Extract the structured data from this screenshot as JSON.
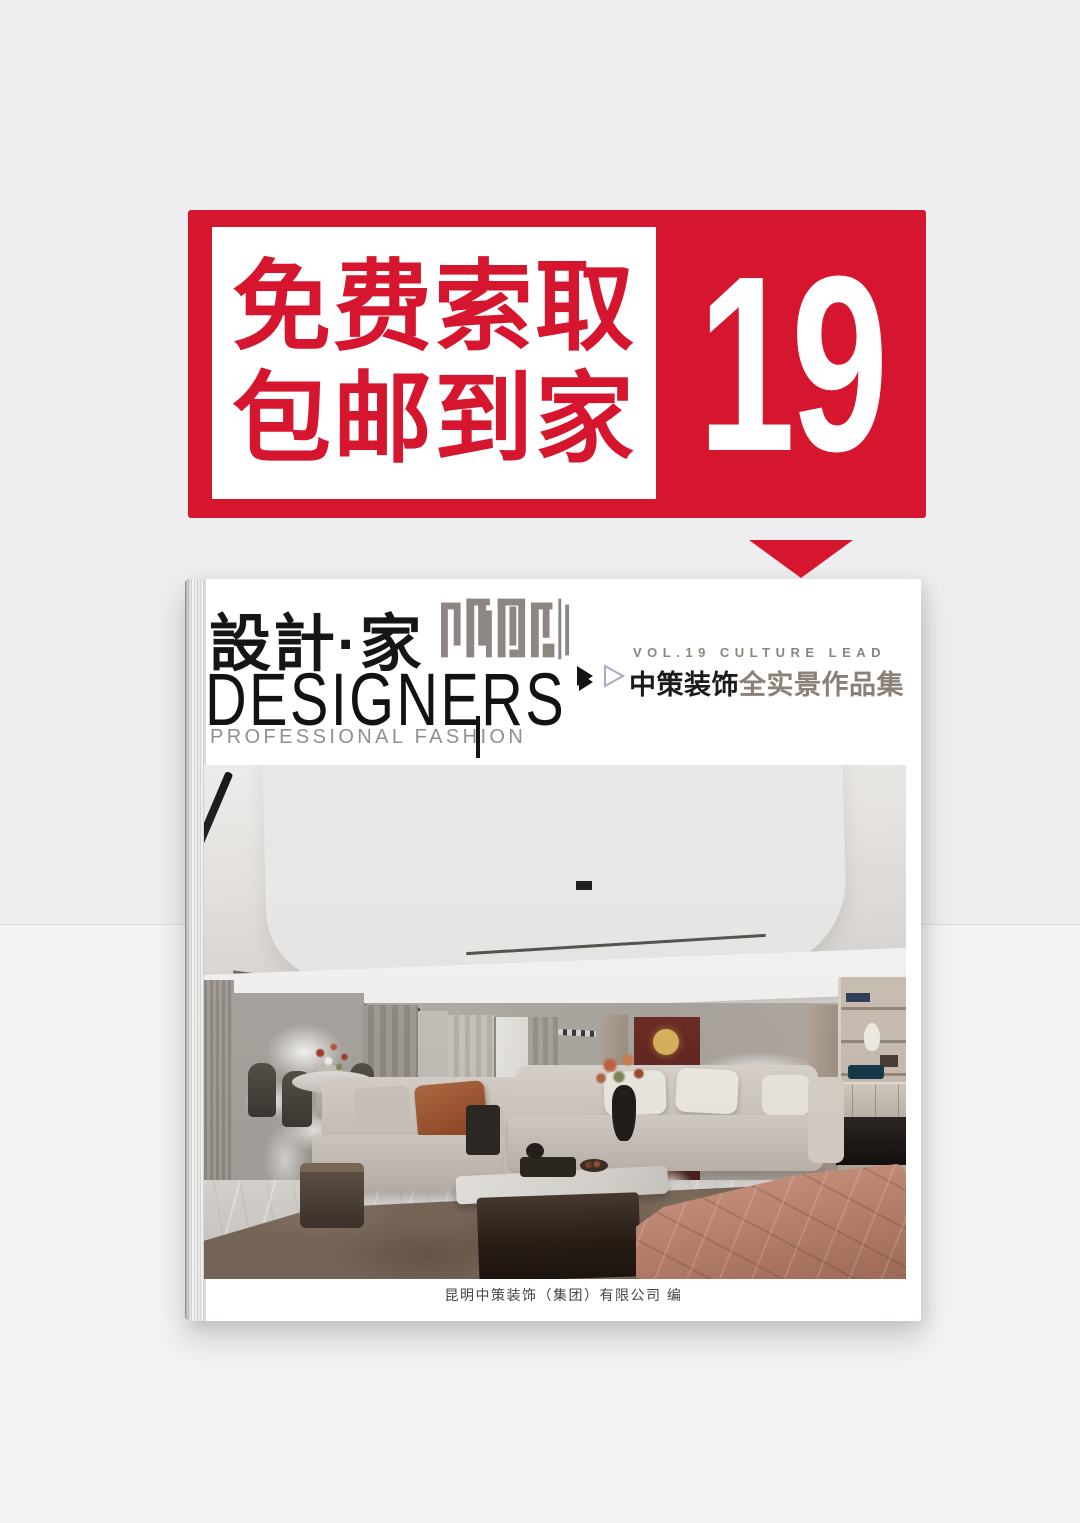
{
  "colors": {
    "accent_red": "#d6162e",
    "background_top": "#eeedef",
    "background_bottom": "#f3f2f4",
    "title_primary_color": "#1c1b1a",
    "title_secondary_color": "#8a8078",
    "seal_gray": "#8d8683"
  },
  "promo_banner": {
    "line1": "免费索取",
    "line2": "包邮到家",
    "volume_number": "19"
  },
  "book_cover": {
    "logo_cn": "設計·家",
    "logo_en": "DESIGNERS",
    "tagline": "PROFESSIONAL FASHION",
    "edition_line": "VOL.19 CULTURE LEAD",
    "title_primary": "中策装饰",
    "title_secondary": "全实景作品集",
    "publisher_line": "昆明中策装饰（集团）有限公司  编"
  }
}
